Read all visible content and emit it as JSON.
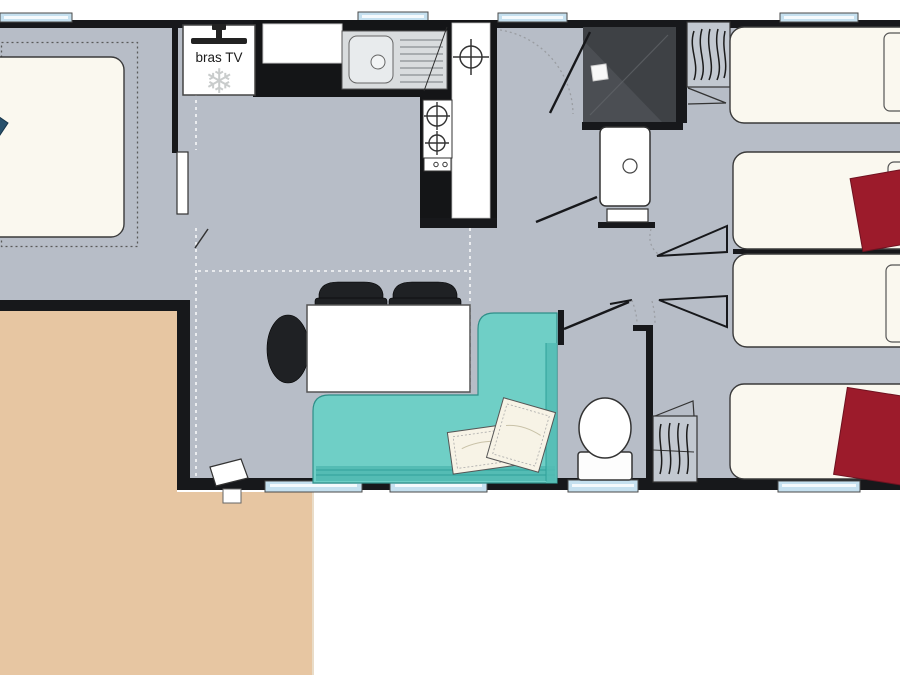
{
  "plan": {
    "labels": {
      "bras_tv": "bras TV"
    },
    "icons": {
      "snowflake": "❄"
    },
    "colors": {
      "floor": "#B7BDC7",
      "wall": "#17181B",
      "terrace": "#E7C6A2",
      "bed": "#FAF8EF",
      "quilt": "#9C1B2B",
      "sofa": "#6FCFC6",
      "sofa_dark": "#54BCB4",
      "sofa_edge": "#2E8E88",
      "pillow": "#F7F3E6",
      "window": "#C5E0EF",
      "shower_dark": "#3E4145",
      "shower_light": "#56595E",
      "steel": "#D9DCDE",
      "counter": "#141517",
      "chair": "#1F2124",
      "wardrobe": "#C2C8D0",
      "snowflake": "#C9CCCC",
      "basin": "#FFFFFF",
      "bed_outline": "#3A3A3A",
      "door_arc": "#9A9DA2"
    },
    "furniture": [
      "double-bed",
      "tv-bracket",
      "fridge-snowflake",
      "kitchen-sink",
      "hob-two-burners",
      "worktop",
      "shower",
      "washbasin",
      "entrance-door",
      "dining-table",
      "dining-chairs",
      "corner-sofa",
      "cushions",
      "toilet",
      "wardrobe-hangers-1",
      "wardrobe-hangers-2",
      "single-bed-1",
      "single-bed-2",
      "single-bed-3",
      "single-bed-4",
      "duvet-1",
      "duvet-2",
      "terrace-deck",
      "windows",
      "folding-doors"
    ]
  }
}
